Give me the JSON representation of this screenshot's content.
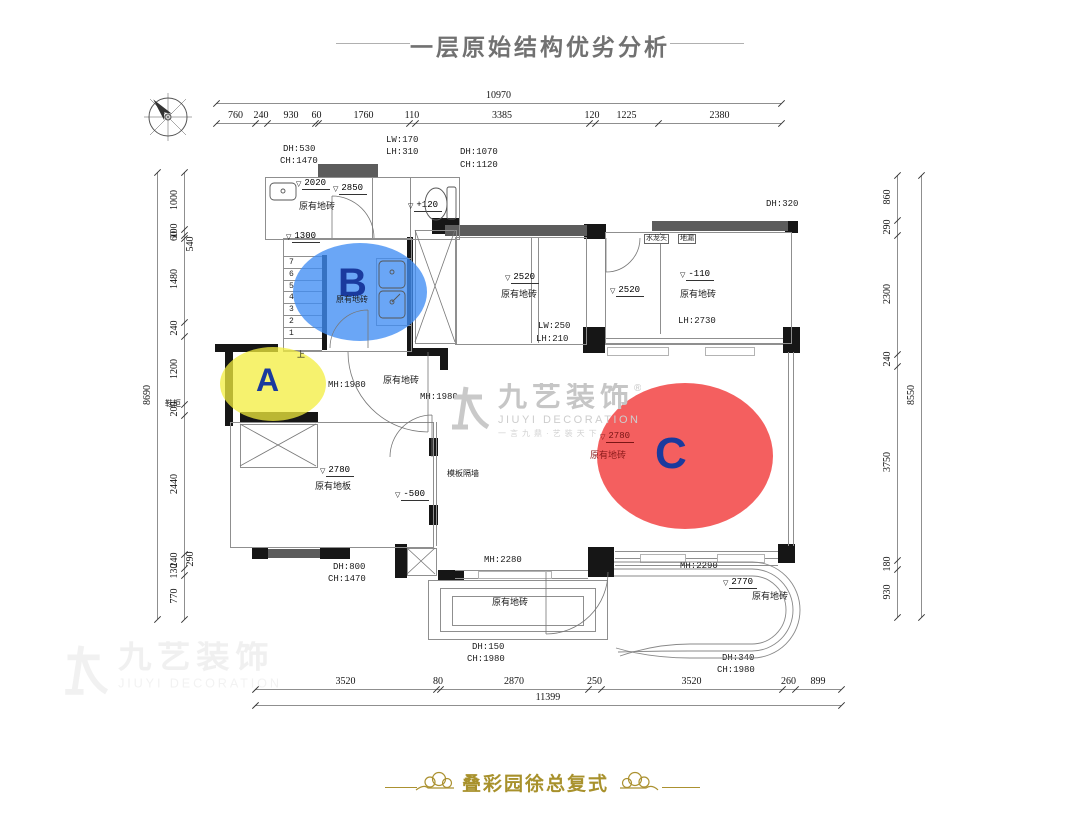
{
  "header": {
    "title": "一层原始结构优劣分析"
  },
  "footer": {
    "project": "叠彩园徐总复式"
  },
  "watermark": {
    "cn": "九艺装饰",
    "reg": "®",
    "en": "JIUYI DECORATION",
    "slogan": "一言九鼎·艺装天下"
  },
  "colors": {
    "zone_a": "rgba(243,238,62,0.75)",
    "zone_b": "rgba(64,141,243,0.78)",
    "zone_c": "rgba(242,62,62,0.83)",
    "letter_blue": "#1a3a9e",
    "title_gray": "#717171",
    "footer_gold": "#a8912c"
  },
  "zones": [
    {
      "id": "A",
      "letter": "A",
      "x": 220,
      "y": 347,
      "w": 106,
      "h": 74,
      "color": "rgba(243,238,62,0.75)",
      "lx": 256,
      "ly": 362,
      "fs": 32
    },
    {
      "id": "B",
      "letter": "B",
      "x": 293,
      "y": 243,
      "w": 134,
      "h": 98,
      "color": "rgba(64,141,243,0.78)",
      "lx": 338,
      "ly": 261,
      "fs": 40
    },
    {
      "id": "C",
      "letter": "C",
      "x": 597,
      "y": 383,
      "w": 176,
      "h": 146,
      "color": "rgba(242,62,62,0.83)",
      "lx": 655,
      "ly": 429,
      "fs": 44
    }
  ],
  "dims": {
    "top": {
      "total": "10970",
      "x0": 216,
      "yTot": 103,
      "ySeg": 123,
      "segments": [
        [
          "760",
          39
        ],
        [
          "240",
          12
        ],
        [
          "930",
          48
        ],
        [
          "60",
          3
        ],
        [
          "1760",
          91
        ],
        [
          "110",
          6
        ],
        [
          "3385",
          174
        ],
        [
          "120",
          6
        ],
        [
          "1225",
          63
        ],
        [
          "2380",
          123
        ]
      ]
    },
    "bottom": {
      "total": "11399",
      "x0": 255,
      "yTot": 705,
      "ySeg": 689,
      "segments": [
        [
          "3520",
          181
        ],
        [
          "80",
          4
        ],
        [
          "2870",
          148
        ],
        [
          "250",
          13
        ],
        [
          "3520",
          181
        ],
        [
          "260",
          13
        ],
        [
          "899",
          46
        ]
      ]
    },
    "left": {
      "total": "8690",
      "y0": 172,
      "xTot": 157,
      "xSeg": 184,
      "segments": [
        [
          "1000",
          57
        ],
        [
          "100",
          6
        ],
        [
          "60",
          3
        ],
        [
          "1480",
          84
        ],
        [
          "240",
          14
        ],
        [
          "1200",
          68
        ],
        [
          "200",
          11
        ],
        [
          "2440",
          139
        ],
        [
          "240",
          14
        ],
        [
          "130",
          7
        ],
        [
          "770",
          44
        ]
      ]
    },
    "right": {
      "total": "8550",
      "y0": 175,
      "xTot": 921,
      "xSeg": 897,
      "segments": [
        [
          "860",
          45
        ],
        [
          "290",
          15
        ],
        [
          "2300",
          119
        ],
        [
          "240",
          12
        ],
        [
          "3750",
          194
        ],
        [
          "180",
          9
        ],
        [
          "930",
          48
        ]
      ]
    }
  },
  "inner_dims": [
    {
      "t": "540",
      "x": 191,
      "y": 245,
      "rot": 1
    },
    {
      "t": "290",
      "x": 191,
      "y": 560,
      "rot": 1
    }
  ],
  "labels": [
    {
      "t": "DH:530",
      "x": 283,
      "y": 145
    },
    {
      "t": "CH:1470",
      "x": 280,
      "y": 157
    },
    {
      "t": "LW:170",
      "x": 386,
      "y": 136
    },
    {
      "t": "LH:310",
      "x": 386,
      "y": 148
    },
    {
      "t": "DH:1070",
      "x": 460,
      "y": 148
    },
    {
      "t": "CH:1120",
      "x": 460,
      "y": 161
    },
    {
      "t": "原有地砖",
      "x": 299,
      "y": 203
    },
    {
      "t": "DH:320",
      "x": 766,
      "y": 200
    },
    {
      "t": "原有地砖",
      "x": 336,
      "y": 297,
      "small": 1
    },
    {
      "t": "原有地砖",
      "x": 501,
      "y": 291
    },
    {
      "t": "原有地砖",
      "x": 680,
      "y": 291
    },
    {
      "t": "LW:250",
      "x": 538,
      "y": 322
    },
    {
      "t": "LH:210",
      "x": 536,
      "y": 335
    },
    {
      "t": "LH:2730",
      "x": 678,
      "y": 317
    },
    {
      "t": "MH:1980",
      "x": 328,
      "y": 381
    },
    {
      "t": "原有地砖",
      "x": 383,
      "y": 377
    },
    {
      "t": "MH:1980",
      "x": 420,
      "y": 393
    },
    {
      "t": "鞋柜",
      "x": 165,
      "y": 401,
      "small": 1
    },
    {
      "t": "上",
      "x": 297,
      "y": 352,
      "small": 1
    },
    {
      "t": "原有地板",
      "x": 315,
      "y": 483
    },
    {
      "t": "模板隔墙",
      "x": 447,
      "y": 471,
      "small": 1
    },
    {
      "t": "原有地砖",
      "x": 590,
      "y": 452,
      "c": "#8b1a1a"
    },
    {
      "t": "MH:2280",
      "x": 484,
      "y": 556
    },
    {
      "t": "DH:800",
      "x": 333,
      "y": 563
    },
    {
      "t": "CH:1470",
      "x": 328,
      "y": 575
    },
    {
      "t": "原有地砖",
      "x": 492,
      "y": 599
    },
    {
      "t": "DH:150",
      "x": 472,
      "y": 643
    },
    {
      "t": "CH:1980",
      "x": 467,
      "y": 655
    },
    {
      "t": "MH:2290",
      "x": 680,
      "y": 562
    },
    {
      "t": "原有地砖",
      "x": 752,
      "y": 593
    },
    {
      "t": "DH:340",
      "x": 722,
      "y": 654
    },
    {
      "t": "CH:1980",
      "x": 717,
      "y": 666
    }
  ],
  "levels": [
    {
      "t": "2020",
      "x": 296,
      "y": 178
    },
    {
      "t": "2850",
      "x": 333,
      "y": 183
    },
    {
      "t": "+120",
      "x": 408,
      "y": 200
    },
    {
      "t": "1300",
      "x": 286,
      "y": 231
    },
    {
      "t": "2520",
      "x": 505,
      "y": 272
    },
    {
      "t": "2520",
      "x": 610,
      "y": 285
    },
    {
      "t": "-110",
      "x": 680,
      "y": 269
    },
    {
      "t": "2780",
      "x": 320,
      "y": 465
    },
    {
      "t": "-500",
      "x": 395,
      "y": 489
    },
    {
      "t": "2780",
      "x": 600,
      "y": 431,
      "c": "#7a1515"
    },
    {
      "t": "2770",
      "x": 723,
      "y": 577
    }
  ],
  "tags": [
    {
      "t": "水龙头",
      "x": 644,
      "y": 234
    },
    {
      "t": "地漏",
      "x": 678,
      "y": 234
    }
  ],
  "stairs": {
    "x": 283,
    "w": 39,
    "yTop": 256,
    "step": 11.75,
    "count": 8,
    "numbers": [
      "7",
      "6",
      "5",
      "4",
      "3",
      "2",
      "1"
    ],
    "numX": 289
  },
  "plan": {
    "black": [
      [
        432,
        218,
        28,
        16
      ],
      [
        584,
        224,
        22,
        15
      ],
      [
        785,
        221,
        13,
        12
      ],
      [
        322,
        255,
        5,
        95
      ],
      [
        407,
        237,
        6,
        113
      ],
      [
        583,
        327,
        22,
        26
      ],
      [
        783,
        327,
        17,
        26
      ],
      [
        215,
        344,
        63,
        8
      ],
      [
        225,
        344,
        8,
        82
      ],
      [
        240,
        412,
        78,
        10
      ],
      [
        407,
        348,
        40,
        8
      ],
      [
        440,
        348,
        8,
        22
      ],
      [
        429,
        438,
        9,
        18
      ],
      [
        429,
        505,
        9,
        20
      ],
      [
        252,
        547,
        16,
        12
      ],
      [
        320,
        547,
        30,
        12
      ],
      [
        395,
        544,
        12,
        34
      ],
      [
        438,
        570,
        26,
        10
      ],
      [
        588,
        547,
        26,
        30
      ],
      [
        778,
        544,
        17,
        19
      ]
    ],
    "gray": [
      [
        318,
        164,
        60,
        13
      ],
      [
        445,
        225,
        142,
        11
      ],
      [
        652,
        221,
        136,
        10
      ],
      [
        268,
        549,
        52,
        9
      ]
    ],
    "rooms": [
      [
        265,
        177,
        193,
        61
      ],
      [
        283,
        238,
        127,
        112
      ],
      [
        415,
        230,
        40,
        112
      ],
      [
        455,
        237,
        130,
        106
      ],
      [
        605,
        232,
        185,
        110
      ],
      [
        230,
        422,
        202,
        124
      ],
      [
        428,
        580,
        178,
        58
      ],
      [
        440,
        588,
        154,
        42
      ],
      [
        452,
        596,
        130,
        28
      ],
      [
        376,
        258,
        34,
        66
      ],
      [
        407,
        548,
        28,
        26
      ],
      [
        240,
        424,
        76,
        42
      ]
    ],
    "lines": [
      [
        372,
        177,
        372,
        238
      ],
      [
        410,
        177,
        410,
        238
      ],
      [
        660,
        232,
        660,
        334
      ],
      [
        531,
        237,
        531,
        343
      ],
      [
        538,
        237,
        538,
        343
      ],
      [
        788,
        352,
        788,
        546
      ],
      [
        793,
        352,
        793,
        546
      ],
      [
        605,
        338,
        783,
        338
      ],
      [
        605,
        344,
        783,
        344
      ],
      [
        455,
        570,
        588,
        570
      ],
      [
        455,
        578,
        588,
        578
      ],
      [
        615,
        551,
        778,
        551
      ],
      [
        615,
        558,
        778,
        558
      ],
      [
        615,
        565,
        778,
        565
      ],
      [
        436,
        422,
        436,
        546
      ]
    ],
    "panels": [
      [
        607,
        347,
        60,
        7
      ],
      [
        705,
        347,
        48,
        7
      ],
      [
        640,
        554,
        44,
        7
      ],
      [
        717,
        554,
        46,
        7
      ],
      [
        478,
        571,
        72,
        6
      ]
    ]
  }
}
